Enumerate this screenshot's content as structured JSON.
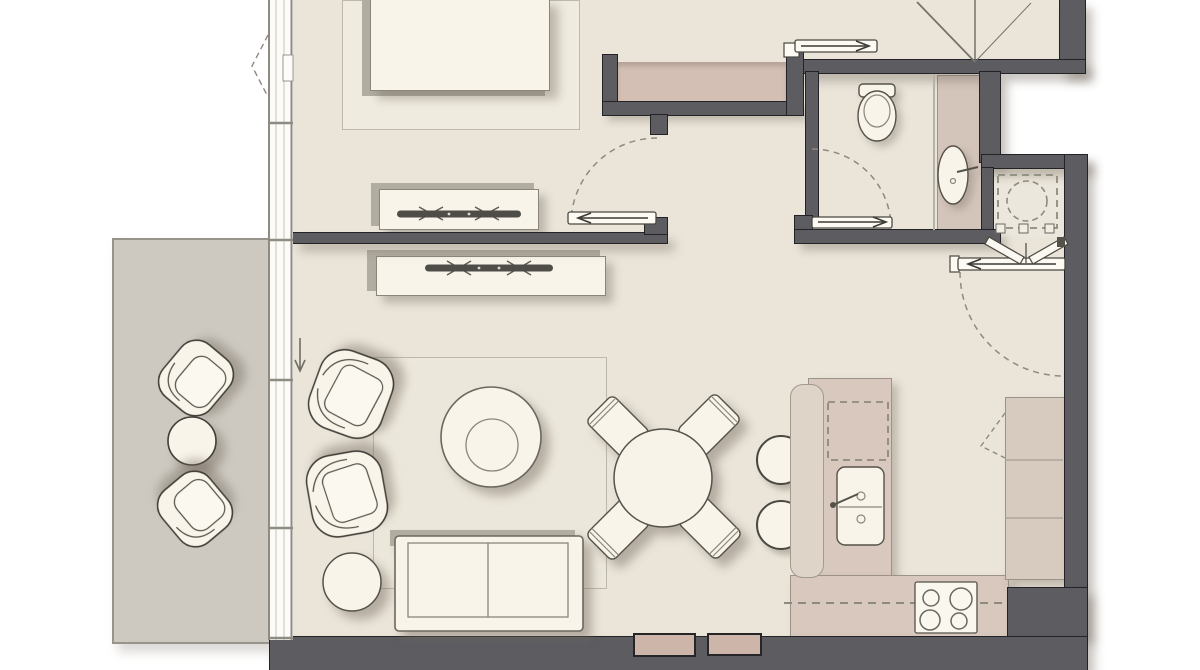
{
  "meta": {
    "description": "Top-down architectural floor plan of a one-bedroom apartment with balcony; rendered drawing, no text labels visible",
    "view": "plan view, furnished"
  },
  "palette": {
    "background": "#ffffff",
    "floor": "#eae4d9",
    "balcony_floor": "#cdc9c1",
    "wall_fill": "#5c5c61",
    "wall_outline": "#232327",
    "wardrobe_fill": "#d3bfb3",
    "counter_fill": "#d8c8bd",
    "furniture_white": "#f8f4ea",
    "line_dark": "#4a4840",
    "dash_gray": "#8f8a7e"
  },
  "rooms": [
    {
      "name": "bedroom",
      "contents": [
        "double-bed",
        "bed-rug",
        "tv-console-bedroom"
      ]
    },
    {
      "name": "hallway",
      "contents": [
        "built-in-wardrobe"
      ]
    },
    {
      "name": "bathroom",
      "contents": [
        "toilet",
        "vanity-counter",
        "oval-sink"
      ]
    },
    {
      "name": "laundry-closet",
      "contents": [
        "washing-machine-dashed",
        "bifold-doors"
      ]
    },
    {
      "name": "entry",
      "contents": [
        "entry-door-lines"
      ]
    },
    {
      "name": "living-dining",
      "contents": [
        "tv-console-living",
        "area-rug",
        "armchair x2",
        "round-coffee-table",
        "pouf",
        "two-seat-sofa",
        "round-dining-table",
        "dining-chair x4"
      ]
    },
    {
      "name": "kitchen",
      "contents": [
        "island-with-sink",
        "dishwasher-dashed",
        "bar-counter",
        "bar-stool x2",
        "cooktop-4-burners",
        "tall-cabinets",
        "base-counter"
      ]
    },
    {
      "name": "balcony",
      "contents": [
        "lounge-chair x2",
        "round-side-table"
      ]
    }
  ],
  "doors": [
    {
      "name": "bedroom-pocket-door",
      "type": "sliding",
      "arrow": "left"
    },
    {
      "name": "bathroom-pocket-door",
      "type": "sliding",
      "arrow": "right"
    },
    {
      "name": "hall-top-pocket-door",
      "type": "sliding",
      "arrow": "right"
    },
    {
      "name": "kitchen-hall-pocket-door",
      "type": "sliding",
      "arrow": "left"
    },
    {
      "name": "laundry-bifold-doors",
      "type": "bifold"
    },
    {
      "name": "balcony-slider",
      "type": "sliding",
      "arrow": "down"
    },
    {
      "name": "bedroom-window-casement",
      "type": "casement-dashed"
    }
  ],
  "swing_arcs": [
    "bedroom-door-arc",
    "bathroom-door-arc",
    "kitchen-door-arc"
  ]
}
